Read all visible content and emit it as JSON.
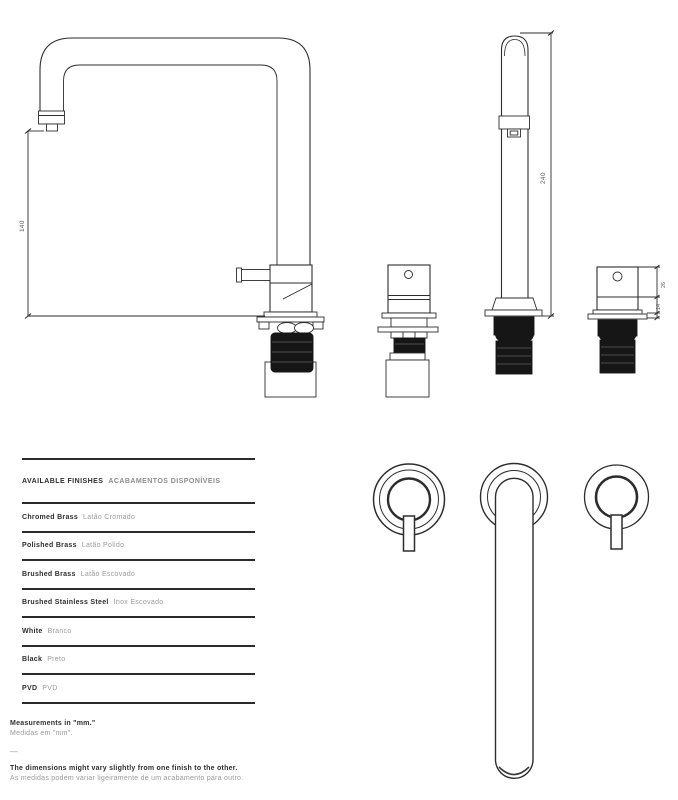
{
  "drawing": {
    "dims": {
      "spout_height": "140",
      "total_height": "240",
      "handle_body_height": "26",
      "handle_base_height": "14"
    }
  },
  "finishes": {
    "header_en": "AVAILABLE FINISHES",
    "header_pt": "ACABAMENTOS DISPONÍVEIS",
    "rows": [
      {
        "en": "Chromed Brass",
        "pt": "Latão Cromado"
      },
      {
        "en": "Polished Brass",
        "pt": "Latão Polido"
      },
      {
        "en": "Brushed Brass",
        "pt": "Latão Escovado"
      },
      {
        "en": "Brushed Stainless Steel",
        "pt": "Inox Escovado"
      },
      {
        "en": "White",
        "pt": "Branco"
      },
      {
        "en": "Black",
        "pt": "Preto"
      },
      {
        "en": "PVD",
        "pt": "PVD"
      }
    ]
  },
  "notes": {
    "measurements_en": "Measurements in \"mm.\"",
    "measurements_pt": "Medidas em \"mm\".",
    "separator": "—",
    "disclaimer_en": "The dimensions might vary slightly from one finish to the other.",
    "disclaimer_pt": "As medidas podem variar ligeiramente de um acabamento para outro."
  },
  "colors": {
    "line": "#2d2d2d",
    "fill_dark": "#161616",
    "dim_text": "#5a5a5a",
    "text_primary": "#2e2e2e",
    "text_secondary": "#9b9b9b"
  }
}
